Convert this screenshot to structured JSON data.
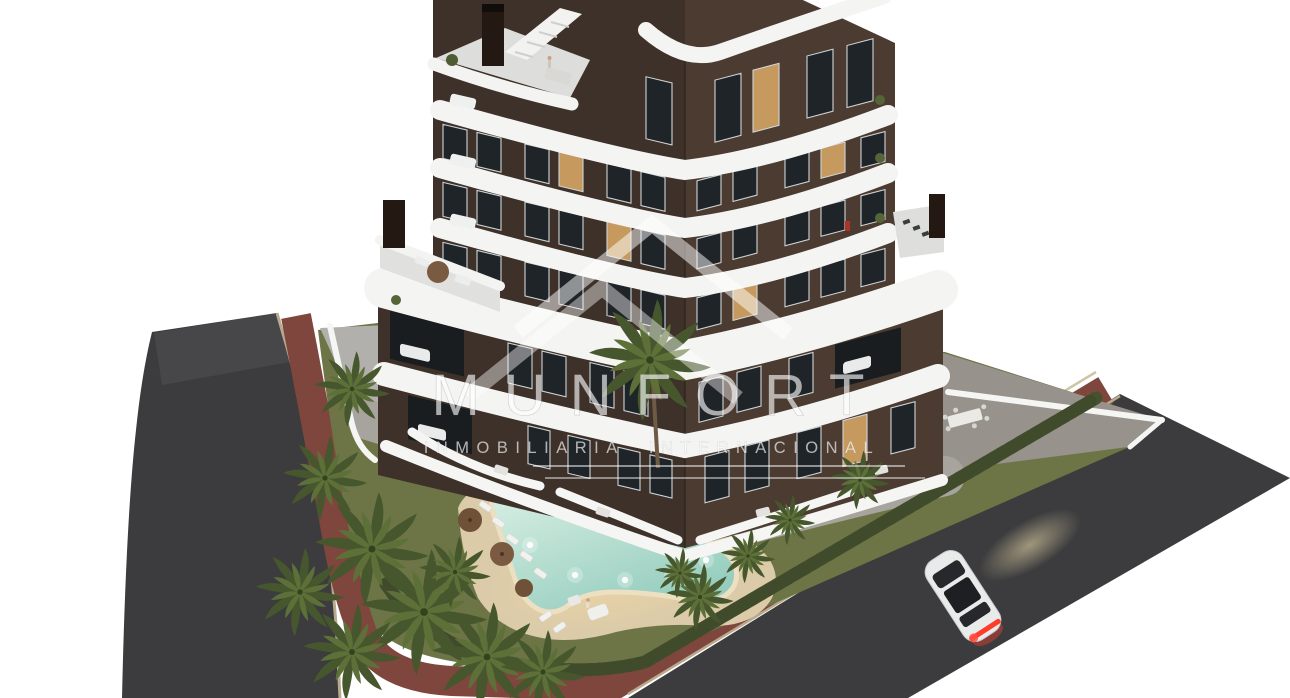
{
  "scene": {
    "type": "3d-architectural-render-aerial",
    "description": "Aerial dusk render of a modern apartment tower with wavy white balcony bands, landscaped garden, boomerang-shaped pool, palm trees, perimeter roads and a white car",
    "watermark": {
      "brand": "MUNFORT",
      "tagline": "INMOBILIARIA INTERNACIONAL",
      "logo": "double-chevron-roofline",
      "color": "#ffffff"
    },
    "building": {
      "floors_visible": 7,
      "style": "dark brown facade with white curved balcony bands",
      "corner_view": true
    },
    "pool": {
      "shape": "boomerang",
      "lit": true,
      "loungers": 7,
      "umbrellas": 3
    },
    "car": {
      "color": "white",
      "taillights_on": true,
      "headlights_on": true
    },
    "colors": {
      "background": "#ffffff",
      "facade_left": "#3e3129",
      "facade_right": "#4b3b31",
      "band_white": "#f4f4f3",
      "window_dark": "#1f2428",
      "window_lit": "#c69a5e",
      "road": "#3c3c3e",
      "sidewalk_red": "#7e463c",
      "curb": "#b9a98e",
      "lawn": "#6d7546",
      "pavement_left": "#b2b0ac",
      "pavement_right": "#97938c",
      "sand": "#dbcba9",
      "water_light": "#d7efe3",
      "water_deep": "#93ccbd",
      "hedge": "#46512e",
      "palm": "#46572e",
      "car_body": "#e9eaea",
      "taillight": "#ff3b2a"
    }
  }
}
